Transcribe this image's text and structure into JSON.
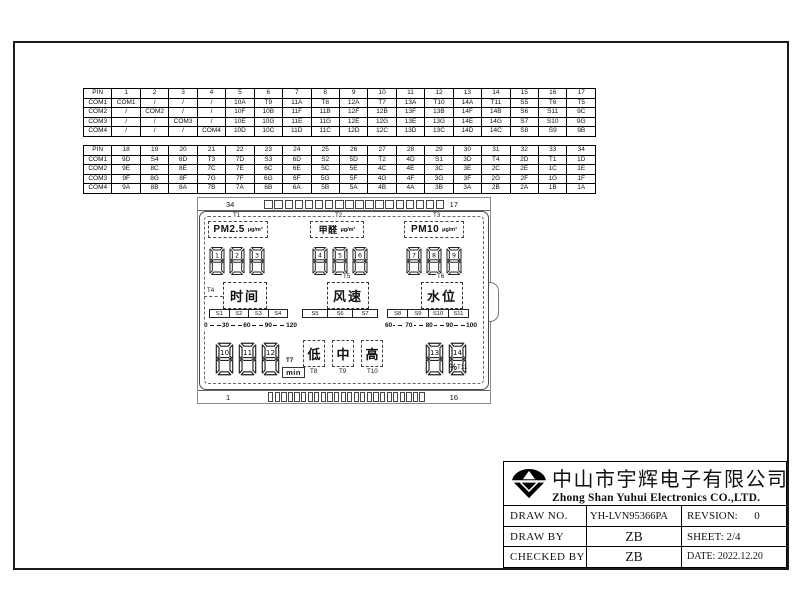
{
  "pin_tables": [
    {
      "header": [
        "PIN",
        "1",
        "2",
        "3",
        "4",
        "5",
        "6",
        "7",
        "8",
        "9",
        "10",
        "11",
        "12",
        "13",
        "14",
        "15",
        "16",
        "17"
      ],
      "rows": [
        [
          "COM1",
          "COM1",
          "/",
          "/",
          "/",
          "10A",
          "T9",
          "11A",
          "T8",
          "12A",
          "T7",
          "13A",
          "T10",
          "14A",
          "T11",
          "S5",
          "T6",
          "T5"
        ],
        [
          "COM2",
          "/",
          "COM2",
          "/",
          "/",
          "10F",
          "10B",
          "11F",
          "11B",
          "12F",
          "12B",
          "13F",
          "13B",
          "14F",
          "14B",
          "S6",
          "S11",
          "9C"
        ],
        [
          "COM3",
          "/",
          "/",
          "COM3",
          "/",
          "10E",
          "10G",
          "11E",
          "11G",
          "12E",
          "12G",
          "13E",
          "13G",
          "14E",
          "14G",
          "S7",
          "S10",
          "9G"
        ],
        [
          "COM4",
          "/",
          "/",
          "/",
          "COM4",
          "10D",
          "10C",
          "11D",
          "11C",
          "12D",
          "12C",
          "13D",
          "13C",
          "14D",
          "14C",
          "S8",
          "S9",
          "9B"
        ]
      ]
    },
    {
      "header": [
        "PIN",
        "18",
        "19",
        "20",
        "21",
        "22",
        "23",
        "24",
        "25",
        "26",
        "27",
        "28",
        "29",
        "30",
        "31",
        "32",
        "33",
        "34"
      ],
      "rows": [
        [
          "COM1",
          "9D",
          "S4",
          "8D",
          "T3",
          "7D",
          "S3",
          "6D",
          "S2",
          "5D",
          "T2",
          "4D",
          "S1",
          "3D",
          "T4",
          "2D",
          "T1",
          "1D"
        ],
        [
          "COM2",
          "9E",
          "8C",
          "8E",
          "7C",
          "7E",
          "6C",
          "6E",
          "5C",
          "5E",
          "4C",
          "4E",
          "3C",
          "3E",
          "2C",
          "2E",
          "1C",
          "1E"
        ],
        [
          "COM3",
          "9F",
          "8G",
          "8F",
          "7G",
          "7F",
          "6G",
          "6F",
          "5G",
          "5F",
          "4G",
          "4F",
          "3G",
          "3F",
          "2G",
          "2F",
          "1G",
          "1F"
        ],
        [
          "COM4",
          "9A",
          "8B",
          "8A",
          "7B",
          "7A",
          "6B",
          "6A",
          "5B",
          "5A",
          "4B",
          "4A",
          "3B",
          "3A",
          "2B",
          "2A",
          "1B",
          "1A"
        ]
      ]
    }
  ],
  "lcd": {
    "top_left_pin": "34",
    "top_right_pin": "17",
    "bottom_left_pin": "1",
    "bottom_right_pin": "16",
    "panels": [
      {
        "t": "T1",
        "label": "PM2.5",
        "unit": "µg/m³",
        "digits": [
          "1",
          "2",
          "3"
        ]
      },
      {
        "t": "T2",
        "label": "甲醛",
        "unit": "µg/m³",
        "digits": [
          "4",
          "5",
          "6"
        ]
      },
      {
        "t": "T3",
        "label": "PM10",
        "unit": "µg/m³",
        "digits": [
          "7",
          "8",
          "9"
        ]
      }
    ],
    "functions": [
      {
        "t": "T4",
        "label": "时间",
        "segments": [
          "S1",
          "S2",
          "S3",
          "S4"
        ],
        "scale": [
          "0",
          "30",
          "60",
          "90",
          "120"
        ]
      },
      {
        "t": "T5",
        "label": "风速",
        "segments": [
          "S5",
          "S6",
          "S7"
        ],
        "scale": []
      },
      {
        "t": "T6",
        "label": "水位",
        "segments": [
          "S8",
          "S9",
          "S10",
          "S11"
        ],
        "scale": [
          "60",
          "70",
          "80",
          "90",
          "100"
        ]
      }
    ],
    "bottom": {
      "digits_left": [
        "10",
        "11",
        "12"
      ],
      "t7": {
        "t": "T7",
        "label": "min"
      },
      "levels": [
        {
          "t": "T8",
          "label": "低"
        },
        {
          "t": "T9",
          "label": "中"
        },
        {
          "t": "T10",
          "label": "高"
        }
      ],
      "digits_right": [
        "13",
        "14"
      ],
      "t11": {
        "t": "T11",
        "icon": "%"
      }
    }
  },
  "title_block": {
    "company_cn": "中山市宇辉电子有限公司",
    "company_en": "Zhong Shan Yuhui Electronics CO.,LTD.",
    "rows": [
      {
        "label": "DRAW NO.",
        "value": "YH-LVN95366PA",
        "right": "REVSION:      0"
      },
      {
        "label": "DRAW BY",
        "value": "ZB",
        "right": "SHEET: 2/4"
      },
      {
        "label": "CHECKED BY",
        "value": "ZB",
        "right": "DATE: 2022.12.20"
      }
    ]
  }
}
